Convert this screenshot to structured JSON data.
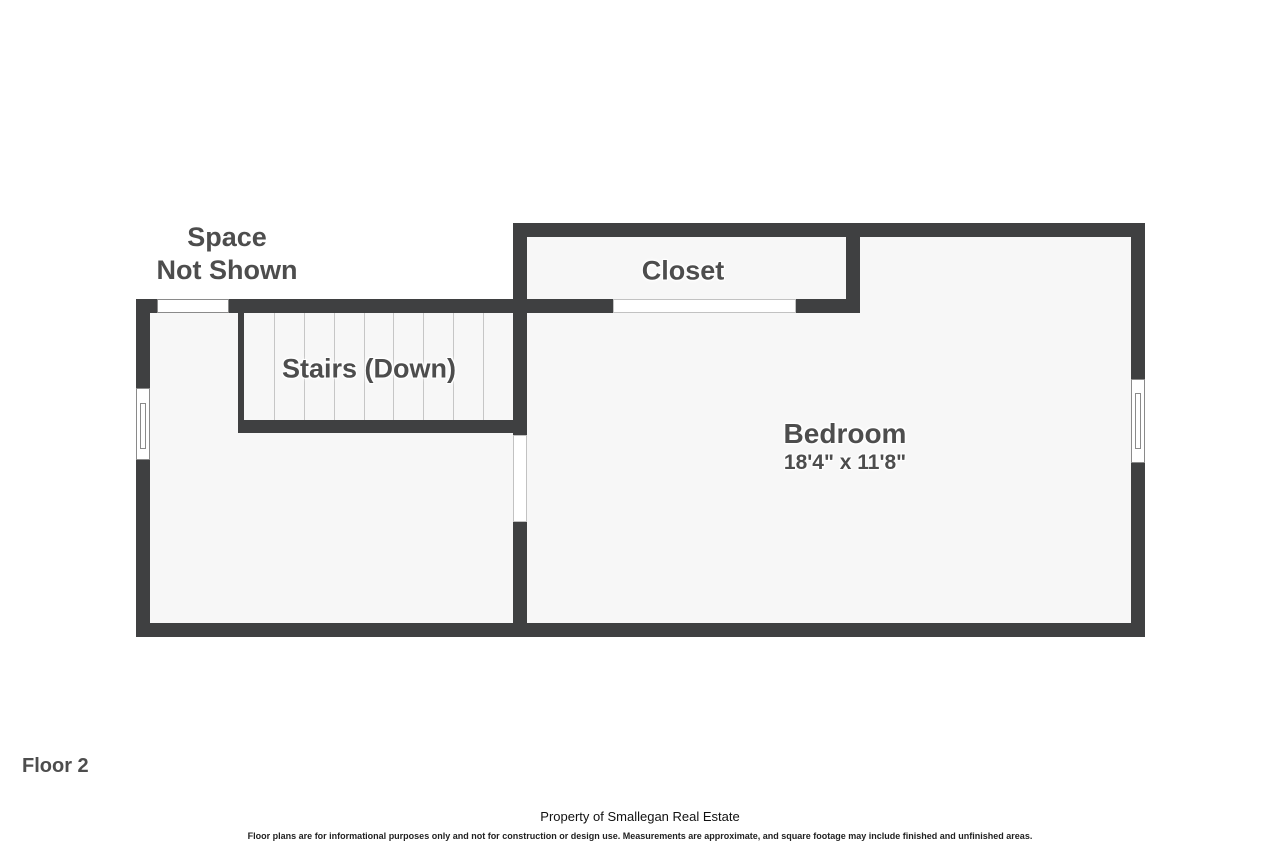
{
  "floorplan": {
    "areas": {
      "space_not_shown": "Space\nNot Shown",
      "closet": "Closet",
      "stairs": "Stairs (Down)",
      "bedroom": {
        "name": "Bedroom",
        "dimensions": "18'4\" x 11'8\""
      }
    },
    "floor_label": "Floor 2",
    "footer": {
      "property_line": "Property of Smallegan Real Estate",
      "disclaimer": "Floor plans are for informational purposes only and not for construction or design use. Measurements are approximate, and square footage may include finished and unfinished areas."
    },
    "colors": {
      "wall": "#3f4041",
      "floor": "#f7f7f7",
      "label_text": "#4d4d4d",
      "background": "#ffffff"
    }
  }
}
